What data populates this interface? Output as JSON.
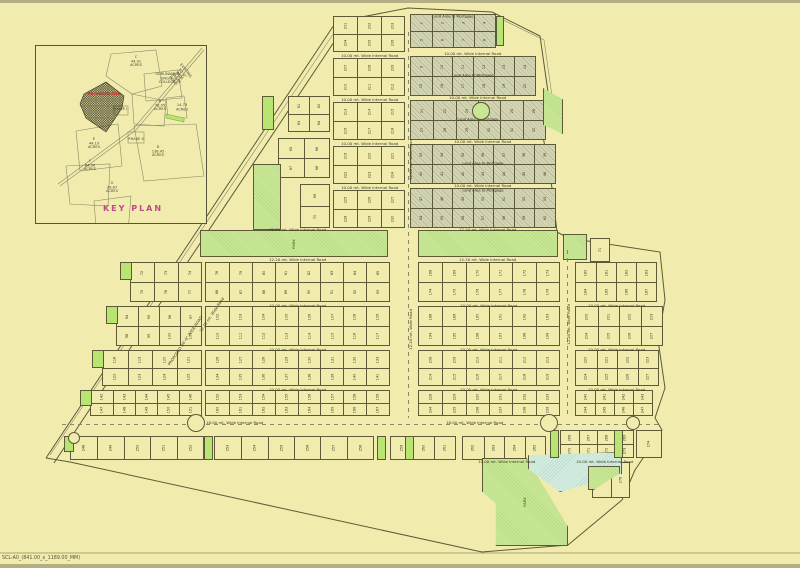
{
  "page": {
    "sheet_label": "SCL-A0_(841.00_x_1189.00_MM)"
  },
  "colors": {
    "paper": "#f1ecae",
    "line": "#5c5a38",
    "park": "#c8e795",
    "mortgage": "#d2d4b2",
    "water": "#d2ecdf",
    "red": "#cf2a27",
    "magenta": "#c2458d"
  },
  "key_plan": {
    "title": "KEY PLAN",
    "labels": [
      {
        "t": "C\n44.91\nACRES",
        "x": 100,
        "y": 16
      },
      {
        "t": "GURUNANAK\nENGG.\nCOLLEGE",
        "x": 131,
        "y": 33
      },
      {
        "t": "B\n78.05\nACRES",
        "x": 124,
        "y": 60
      },
      {
        "t": "14.73\nACRES",
        "x": 146,
        "y": 62
      },
      {
        "t": "PROPOSED SITE",
        "x": 68,
        "y": 49,
        "cls": "red"
      },
      {
        "t": "PHASE I",
        "x": 84,
        "y": 64
      },
      {
        "t": "PHASE II",
        "x": 100,
        "y": 94
      },
      {
        "t": "D\n136.45\nACRES",
        "x": 122,
        "y": 106
      },
      {
        "t": "E\n44.19\nACRES",
        "x": 58,
        "y": 98
      },
      {
        "t": "F\n84.06\nACRES",
        "x": 54,
        "y": 120
      },
      {
        "t": "G\n29.87\nACRES",
        "x": 76,
        "y": 142
      },
      {
        "t": "EXISTING 80'-0\" WIDE SAGAR ROAD",
        "x": 143,
        "y": 30,
        "cls": "rot"
      }
    ]
  },
  "site": {
    "internal_road_label": "10.00 mt. Wide Internal Road",
    "mortgage_label": "Land Area to Mortgage",
    "park_label": "PARK",
    "blocks": [
      {
        "x": 333,
        "y": 16,
        "w": 72,
        "h": 36,
        "r": 2,
        "c": 3,
        "t": "p",
        "n": 201
      },
      {
        "x": 333,
        "y": 58,
        "w": 72,
        "h": 38,
        "r": 2,
        "c": 3,
        "t": "p",
        "n": 207
      },
      {
        "x": 333,
        "y": 102,
        "w": 72,
        "h": 38,
        "r": 2,
        "c": 3,
        "t": "p",
        "n": 213
      },
      {
        "x": 333,
        "y": 146,
        "w": 72,
        "h": 38,
        "r": 2,
        "c": 3,
        "t": "p",
        "n": 219
      },
      {
        "x": 333,
        "y": 190,
        "w": 72,
        "h": 38,
        "r": 2,
        "c": 3,
        "t": "p",
        "n": 225
      },
      {
        "x": 410,
        "y": 14,
        "w": 86,
        "h": 34,
        "r": 2,
        "c": 4,
        "t": "m",
        "ml": "top",
        "n": 1
      },
      {
        "x": 410,
        "y": 56,
        "w": 126,
        "h": 40,
        "r": 2,
        "c": 6,
        "t": "m",
        "ml": "mid",
        "n": 9
      },
      {
        "x": 410,
        "y": 100,
        "w": 136,
        "h": 40,
        "r": 2,
        "c": 6,
        "t": "m",
        "ml": "mid",
        "n": 21
      },
      {
        "x": 410,
        "y": 144,
        "w": 146,
        "h": 40,
        "r": 2,
        "c": 7,
        "t": "m",
        "ml": "mid",
        "n": 33
      },
      {
        "x": 410,
        "y": 188,
        "w": 146,
        "h": 40,
        "r": 2,
        "c": 7,
        "t": "m",
        "ml": "top",
        "n": 47
      },
      {
        "x": 288,
        "y": 96,
        "w": 42,
        "h": 36,
        "r": 2,
        "c": 2,
        "t": "p",
        "n": 61
      },
      {
        "x": 278,
        "y": 138,
        "w": 52,
        "h": 40,
        "r": 2,
        "c": 2,
        "t": "p",
        "n": 65
      },
      {
        "x": 300,
        "y": 184,
        "w": 30,
        "h": 44,
        "r": 2,
        "c": 1,
        "t": "p",
        "n": 69
      },
      {
        "x": 590,
        "y": 238,
        "w": 20,
        "h": 24,
        "r": 1,
        "c": 1,
        "t": "p",
        "n": 71
      },
      {
        "x": 130,
        "y": 262,
        "w": 72,
        "h": 40,
        "r": 2,
        "c": 3,
        "t": "p",
        "n": 72
      },
      {
        "x": 205,
        "y": 262,
        "w": 185,
        "h": 40,
        "r": 2,
        "c": 8,
        "t": "p",
        "n": 78
      },
      {
        "x": 116,
        "y": 306,
        "w": 86,
        "h": 40,
        "r": 2,
        "c": 4,
        "t": "p",
        "n": 94
      },
      {
        "x": 205,
        "y": 306,
        "w": 185,
        "h": 40,
        "r": 2,
        "c": 8,
        "t": "p",
        "n": 102
      },
      {
        "x": 102,
        "y": 350,
        "w": 100,
        "h": 36,
        "r": 2,
        "c": 4,
        "t": "p",
        "n": 118
      },
      {
        "x": 205,
        "y": 350,
        "w": 185,
        "h": 36,
        "r": 2,
        "c": 8,
        "t": "p",
        "n": 126
      },
      {
        "x": 90,
        "y": 390,
        "w": 112,
        "h": 26,
        "r": 2,
        "c": 5,
        "t": "p",
        "n": 142
      },
      {
        "x": 205,
        "y": 390,
        "w": 185,
        "h": 26,
        "r": 2,
        "c": 8,
        "t": "p",
        "n": 152
      },
      {
        "x": 418,
        "y": 262,
        "w": 142,
        "h": 40,
        "r": 2,
        "c": 6,
        "t": "p",
        "n": 168
      },
      {
        "x": 575,
        "y": 262,
        "w": 82,
        "h": 40,
        "r": 2,
        "c": 4,
        "t": "p",
        "n": 180
      },
      {
        "x": 418,
        "y": 306,
        "w": 142,
        "h": 40,
        "r": 2,
        "c": 6,
        "t": "p",
        "n": 188
      },
      {
        "x": 575,
        "y": 306,
        "w": 88,
        "h": 40,
        "r": 2,
        "c": 4,
        "t": "p",
        "n": 200
      },
      {
        "x": 418,
        "y": 350,
        "w": 142,
        "h": 36,
        "r": 2,
        "c": 6,
        "t": "p",
        "n": 208
      },
      {
        "x": 575,
        "y": 350,
        "w": 84,
        "h": 36,
        "r": 2,
        "c": 4,
        "t": "p",
        "n": 220
      },
      {
        "x": 418,
        "y": 390,
        "w": 142,
        "h": 26,
        "r": 2,
        "c": 6,
        "t": "p",
        "n": 228
      },
      {
        "x": 575,
        "y": 390,
        "w": 78,
        "h": 26,
        "r": 2,
        "c": 4,
        "t": "p",
        "n": 240
      },
      {
        "x": 70,
        "y": 436,
        "w": 134,
        "h": 24,
        "r": 1,
        "c": 5,
        "t": "p",
        "n": 248
      },
      {
        "x": 214,
        "y": 436,
        "w": 160,
        "h": 24,
        "r": 1,
        "c": 6,
        "t": "p",
        "n": 253
      },
      {
        "x": 390,
        "y": 436,
        "w": 66,
        "h": 24,
        "r": 1,
        "c": 3,
        "t": "p",
        "n": 259
      },
      {
        "x": 462,
        "y": 436,
        "w": 84,
        "h": 24,
        "r": 1,
        "c": 4,
        "t": "p",
        "n": 262
      },
      {
        "x": 560,
        "y": 430,
        "w": 74,
        "h": 28,
        "r": 2,
        "c": 4,
        "t": "p",
        "n": 266
      },
      {
        "x": 636,
        "y": 430,
        "w": 26,
        "h": 28,
        "r": 1,
        "c": 1,
        "t": "p",
        "n": 274
      },
      {
        "x": 592,
        "y": 462,
        "w": 38,
        "h": 36,
        "r": 1,
        "c": 2,
        "t": "p",
        "n": 275
      }
    ],
    "roads": [
      {
        "x": 333,
        "y": 53,
        "w": 72
      },
      {
        "x": 333,
        "y": 97,
        "w": 72
      },
      {
        "x": 333,
        "y": 141,
        "w": 72
      },
      {
        "x": 333,
        "y": 185,
        "w": 72
      },
      {
        "x": 410,
        "y": 51,
        "w": 126
      },
      {
        "x": 410,
        "y": 95,
        "w": 136
      },
      {
        "x": 410,
        "y": 139,
        "w": 146
      },
      {
        "x": 410,
        "y": 183,
        "w": 146
      },
      {
        "x": 205,
        "y": 227,
        "w": 185,
        "l": "12.20 mt. Wide Internal Road"
      },
      {
        "x": 418,
        "y": 227,
        "w": 140,
        "l": "12.20 mt. Wide Internal Road"
      },
      {
        "x": 205,
        "y": 257,
        "w": 185,
        "l": "12.20 mt. Wide Internal Road"
      },
      {
        "x": 418,
        "y": 257,
        "w": 140,
        "l": "12.20 mt. Wide Internal Road"
      },
      {
        "x": 205,
        "y": 303,
        "w": 185
      },
      {
        "x": 418,
        "y": 303,
        "w": 142
      },
      {
        "x": 575,
        "y": 303,
        "w": 84
      },
      {
        "x": 205,
        "y": 347,
        "w": 185
      },
      {
        "x": 418,
        "y": 347,
        "w": 142
      },
      {
        "x": 575,
        "y": 347,
        "w": 84
      },
      {
        "x": 205,
        "y": 387,
        "w": 185
      },
      {
        "x": 418,
        "y": 387,
        "w": 142
      },
      {
        "x": 575,
        "y": 387,
        "w": 84
      },
      {
        "x": 120,
        "y": 420,
        "w": 230,
        "l": "18.00 mt. Wide Internal Road"
      },
      {
        "x": 410,
        "y": 420,
        "w": 130,
        "l": "18.00 mt. Wide Internal Road"
      },
      {
        "x": 462,
        "y": 459,
        "w": 90
      },
      {
        "x": 560,
        "y": 459,
        "w": 90
      }
    ],
    "vroads": [
      {
        "x": 409,
        "y": 180,
        "l": "12.20 mt. Wide Road"
      },
      {
        "x": 409,
        "y": 350,
        "l": "12.20 mt. Wide Road"
      },
      {
        "x": 567,
        "y": 345,
        "l": "12.20 mt. Wide Road"
      }
    ],
    "diagonals": [
      {
        "x": 148,
        "y": 338,
        "rot": -56,
        "l": "PROPOSED 60'-0\" WIDE ROAD"
      },
      {
        "x": 186,
        "y": 312,
        "rot": -56,
        "l": "12.20 mt. Wide Road"
      }
    ],
    "dashes": [
      {
        "d": "h",
        "x": 62,
        "y": 424,
        "len": 598
      },
      {
        "d": "v",
        "x": 408,
        "y": 32,
        "len": 386
      },
      {
        "d": "v",
        "x": 567,
        "y": 250,
        "len": 168
      }
    ],
    "greens": [
      {
        "x": 200,
        "y": 230,
        "w": 188,
        "h": 27,
        "k": "park",
        "lab": true
      },
      {
        "x": 418,
        "y": 230,
        "w": 140,
        "h": 27,
        "k": "park"
      },
      {
        "x": 563,
        "y": 234,
        "w": 24,
        "h": 26,
        "k": "park"
      },
      {
        "x": 253,
        "y": 164,
        "w": 28,
        "h": 66,
        "k": "park"
      },
      {
        "x": 543,
        "y": 88,
        "w": 20,
        "h": 46,
        "k": "park",
        "clip": "polygon(0 0,100% 25%,100% 100%,0 80%)"
      },
      {
        "x": 482,
        "y": 458,
        "w": 86,
        "h": 88,
        "k": "park",
        "lab": true,
        "clip": "polygon(0 0,52% 0,100% 78%,100% 100%,16% 100%,16% 52%,0 38%)"
      },
      {
        "x": 528,
        "y": 452,
        "w": 94,
        "h": 40,
        "k": "water",
        "clip": "polygon(0 8%,100% 0,100% 55%,34% 100%,0 42%)"
      },
      {
        "x": 588,
        "y": 466,
        "w": 32,
        "h": 24,
        "k": "park",
        "clip": "polygon(0 0,100% 0,100% 30%,18% 100%,0 100%)"
      },
      {
        "x": 496,
        "y": 16,
        "w": 8,
        "h": 30,
        "k": "cell-g"
      },
      {
        "x": 262,
        "y": 96,
        "w": 12,
        "h": 34,
        "k": "cell-g"
      },
      {
        "x": 204,
        "y": 436,
        "w": 9,
        "h": 24,
        "k": "cell-g"
      },
      {
        "x": 377,
        "y": 436,
        "w": 9,
        "h": 24,
        "k": "cell-g"
      },
      {
        "x": 405,
        "y": 436,
        "w": 9,
        "h": 24,
        "k": "cell-g"
      },
      {
        "x": 550,
        "y": 430,
        "w": 9,
        "h": 28,
        "k": "cell-g"
      },
      {
        "x": 614,
        "y": 430,
        "w": 9,
        "h": 28,
        "k": "cell-g"
      },
      {
        "x": 120,
        "y": 262,
        "w": 12,
        "h": 18,
        "k": "cell-g"
      },
      {
        "x": 106,
        "y": 306,
        "w": 12,
        "h": 18,
        "k": "cell-g"
      },
      {
        "x": 92,
        "y": 350,
        "w": 12,
        "h": 18,
        "k": "cell-g"
      },
      {
        "x": 80,
        "y": 390,
        "w": 12,
        "h": 16,
        "k": "cell-g"
      },
      {
        "x": 64,
        "y": 436,
        "w": 10,
        "h": 16,
        "k": "cell-g"
      }
    ],
    "circles": [
      {
        "cx": 196,
        "cy": 423,
        "r": 9
      },
      {
        "cx": 549,
        "cy": 423,
        "r": 9
      },
      {
        "cx": 74,
        "cy": 438,
        "r": 6
      },
      {
        "cx": 633,
        "cy": 423,
        "r": 7
      },
      {
        "cx": 481,
        "cy": 111,
        "r": 9,
        "g": true
      }
    ]
  }
}
